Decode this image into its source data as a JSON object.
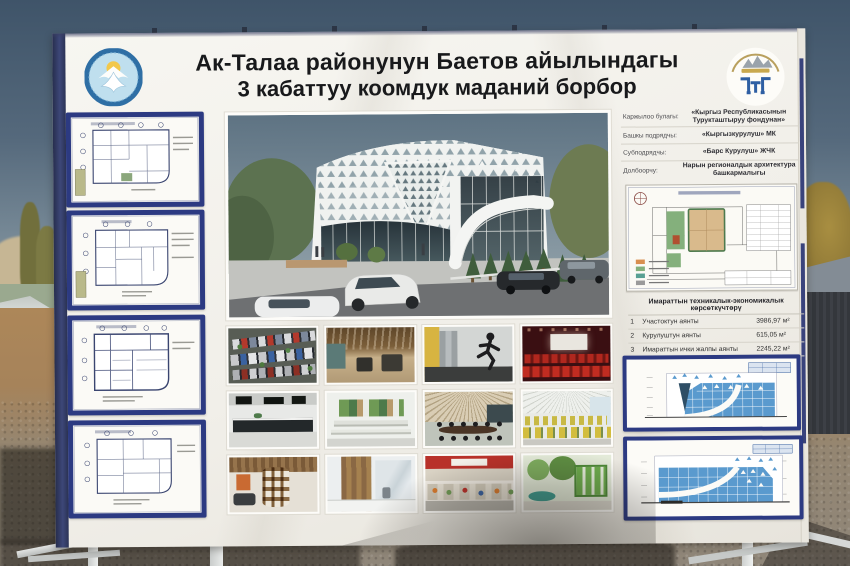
{
  "colors": {
    "frame_navy": "#2c3a82",
    "banner_white": "#f3f1ea",
    "emblem_blue": "#2f6fa5",
    "facade_blue": "#5a9ace",
    "sky_top": "#3f5469"
  },
  "billboard": {
    "title": {
      "line1": "Ак-Талаа районунун Баетов айылындагы",
      "line2": "3 кабаттуу коомдук маданий борбор"
    },
    "project_info": {
      "rows": [
        {
          "label": "Каржылоо булагы:",
          "value": "«Кыргыз Республикасынын Турукташтыруу фондунан»"
        },
        {
          "label": "Башкы подрядчы:",
          "value": "«Кыргызкурулуш» МК"
        },
        {
          "label": "Субподрядчы:",
          "value": "«Барс Курулуш» ЖЧК"
        },
        {
          "label": "Долбоорчу:",
          "value": "Нарын регионалдык архитектура башкармалыгы"
        }
      ]
    },
    "indicators": {
      "title": "Имараттын техникалык-экономикалык көрсөткүчтөрү",
      "rows": [
        {
          "num": "1",
          "name": "Участоктун аянты",
          "value": "3986,97 м²"
        },
        {
          "num": "2",
          "name": "Курулуштун аянты",
          "value": "615,05 м²"
        },
        {
          "num": "3",
          "name": "Имараттын ички жалпы аянты",
          "value": "2245,22 м²"
        },
        {
          "num": "4",
          "name": "Автоунаа токтоочу жайдын саны",
          "value": "50 орун"
        }
      ]
    }
  }
}
